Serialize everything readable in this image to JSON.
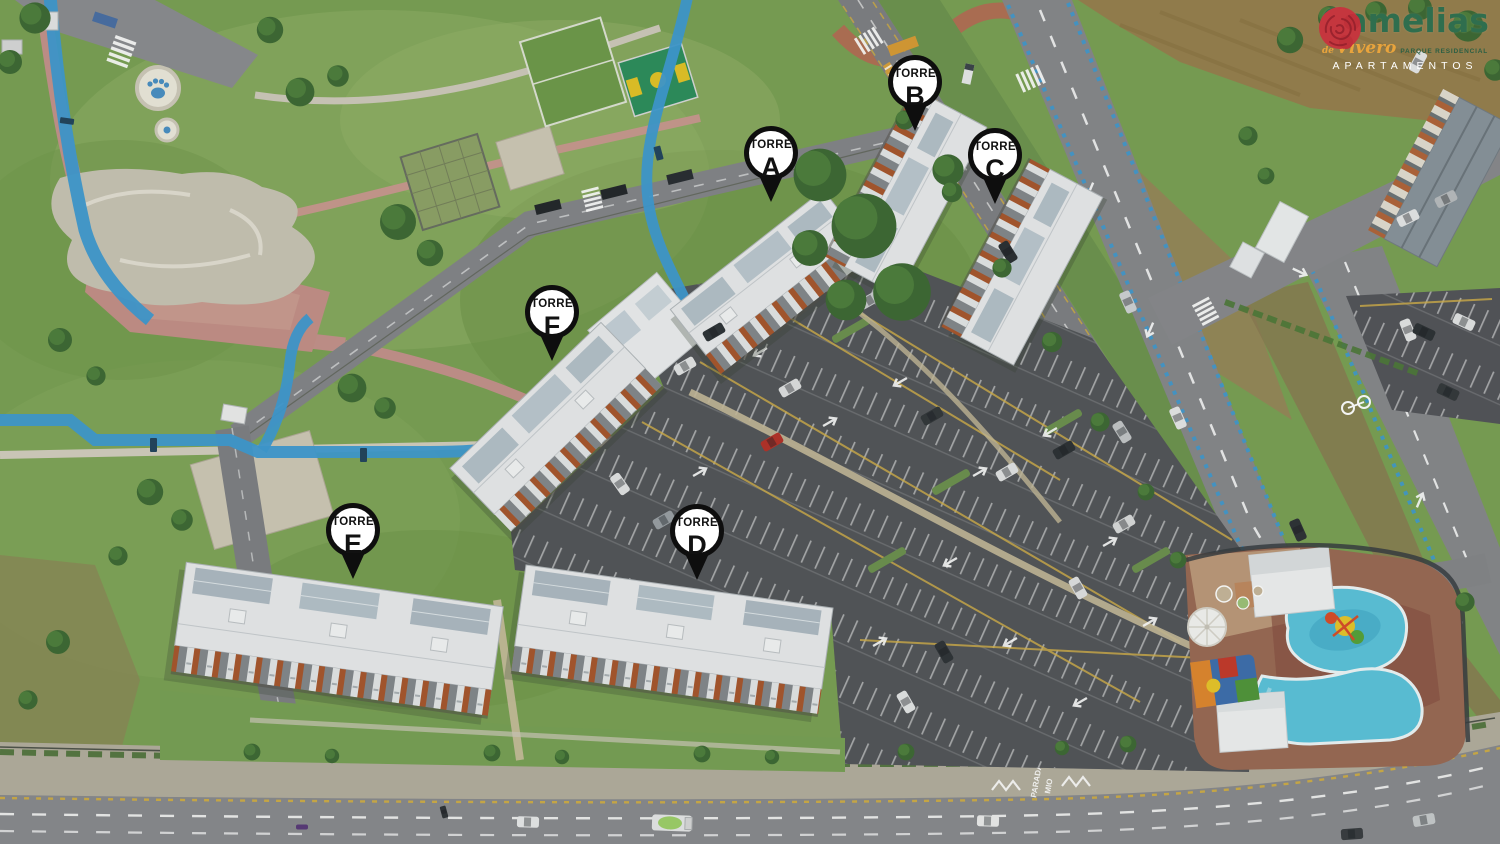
{
  "brand": {
    "name": "Camelias",
    "prefix": "de",
    "script": "Vivero",
    "tagline": "PARQUE RESIDENCIAL",
    "subtitle": "APARTAMENTOS"
  },
  "markers": [
    {
      "title": "TORRE",
      "letter": "A",
      "x": 771,
      "y": 155
    },
    {
      "title": "TORRE",
      "letter": "B",
      "x": 915,
      "y": 84
    },
    {
      "title": "TORRE",
      "letter": "C",
      "x": 995,
      "y": 157
    },
    {
      "title": "TORRE",
      "letter": "D",
      "x": 697,
      "y": 533
    },
    {
      "title": "TORRE",
      "letter": "E",
      "x": 353,
      "y": 532
    },
    {
      "title": "TORRE",
      "letter": "F",
      "x": 552,
      "y": 314
    }
  ],
  "road_text": {
    "bus_stop_line1": "PARADA",
    "bus_stop_line2": "MIO"
  },
  "colors": {
    "brand_red": "#c5363e",
    "brand_green": "#2f6e4e",
    "brand_orange": "#e9a43c",
    "bike_blue": "#3f9ad2",
    "pool_teal": "#5cc3dc"
  }
}
